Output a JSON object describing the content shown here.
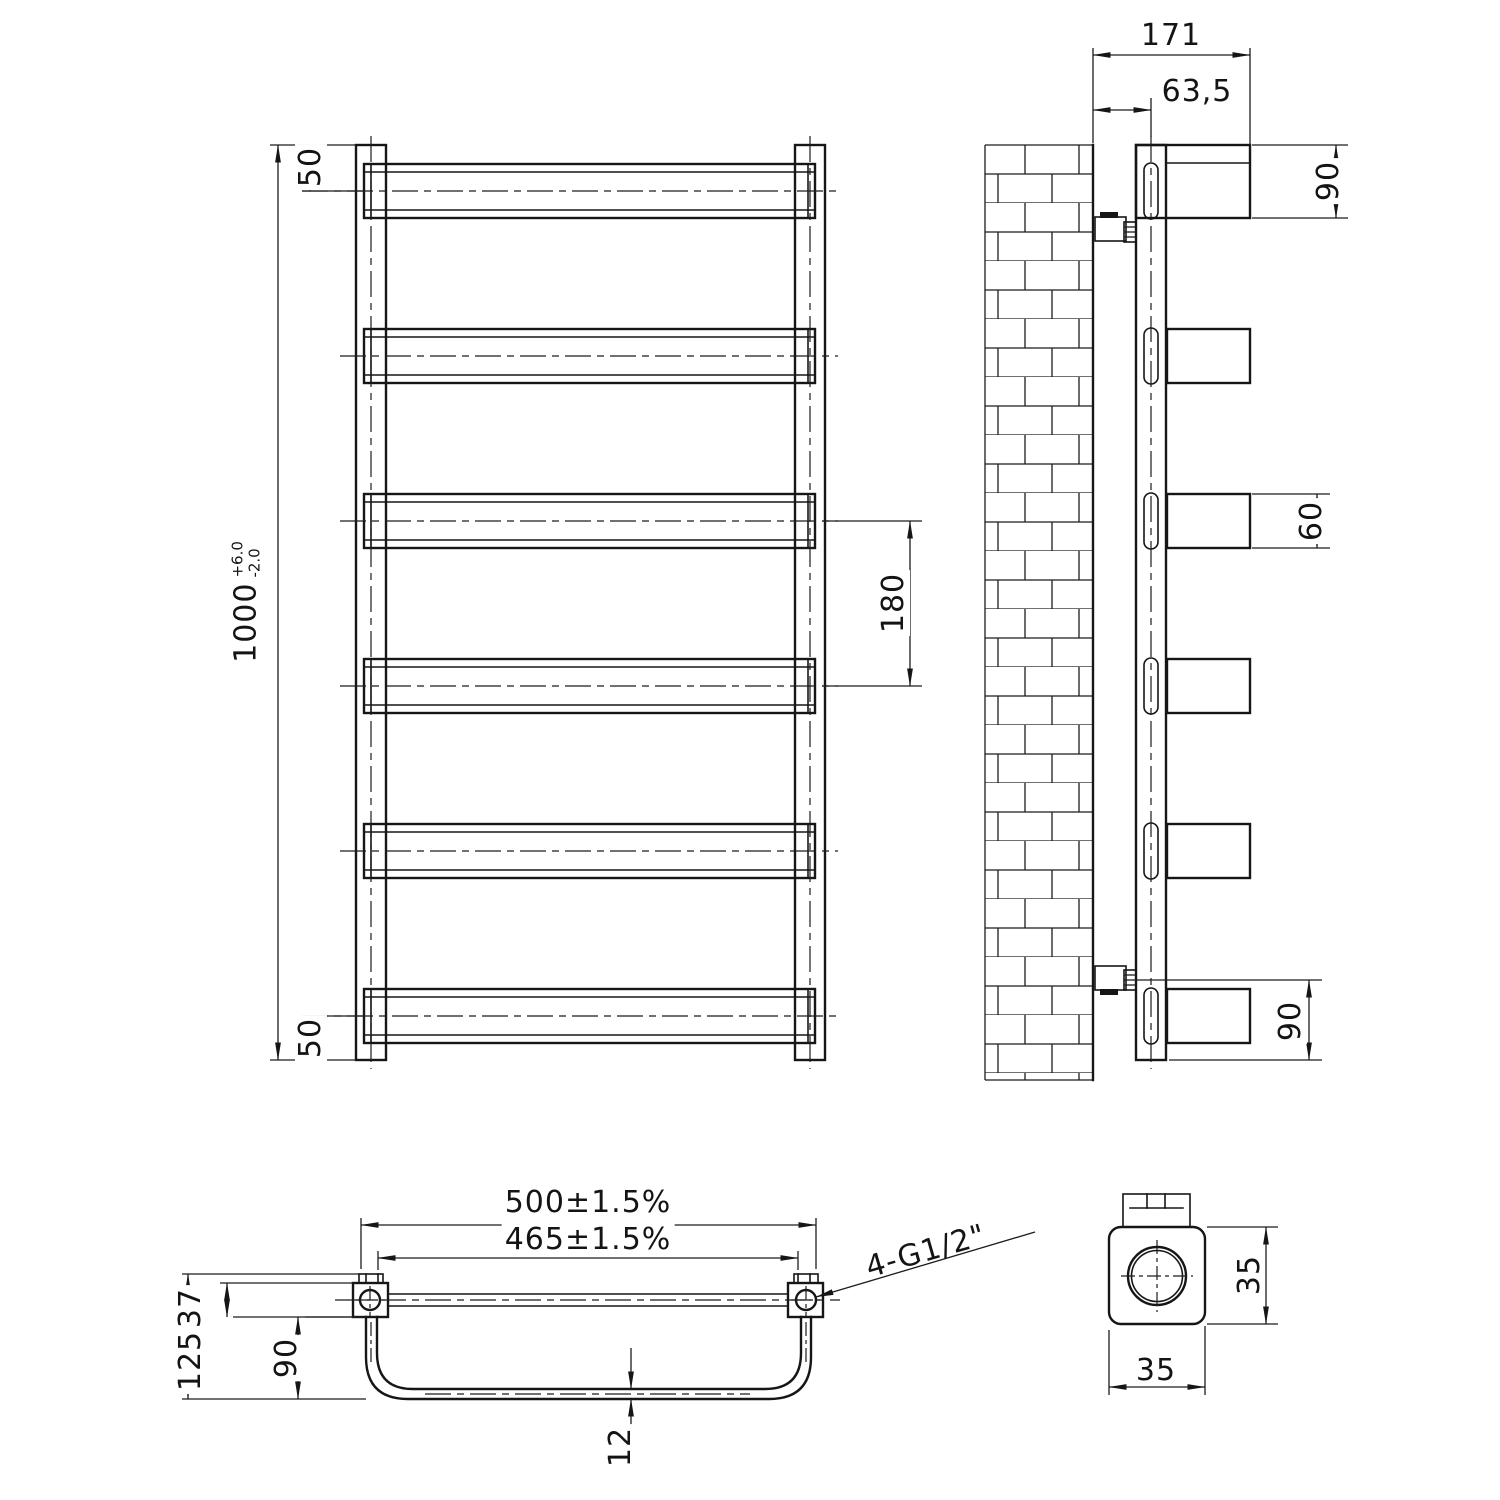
{
  "drawing": {
    "front_view": {
      "dim_height": {
        "value": "1000",
        "tol_plus": "+6.0",
        "tol_minus": "-2.0"
      },
      "dim_top_offset": "50",
      "dim_bottom_offset": "50",
      "dim_bar_pitch": "180"
    },
    "side_view": {
      "dim_depth_total": "171",
      "dim_wall_to_axis": "63,5",
      "dim_top_bar": "90",
      "dim_mid_bar": "60",
      "dim_bottom_bar": "90"
    },
    "plan_view": {
      "dim_width_overall": "500±1.5%",
      "dim_connection_centers": "465±1.5%",
      "dim_depth_overall": "125",
      "dim_wall_offset": "37",
      "dim_bar_depth": "90",
      "dim_tube_thickness": "12",
      "thread_label": "4-G1/2\""
    },
    "detail_view": {
      "dim_profile_height": "35",
      "dim_profile_width": "35"
    }
  }
}
